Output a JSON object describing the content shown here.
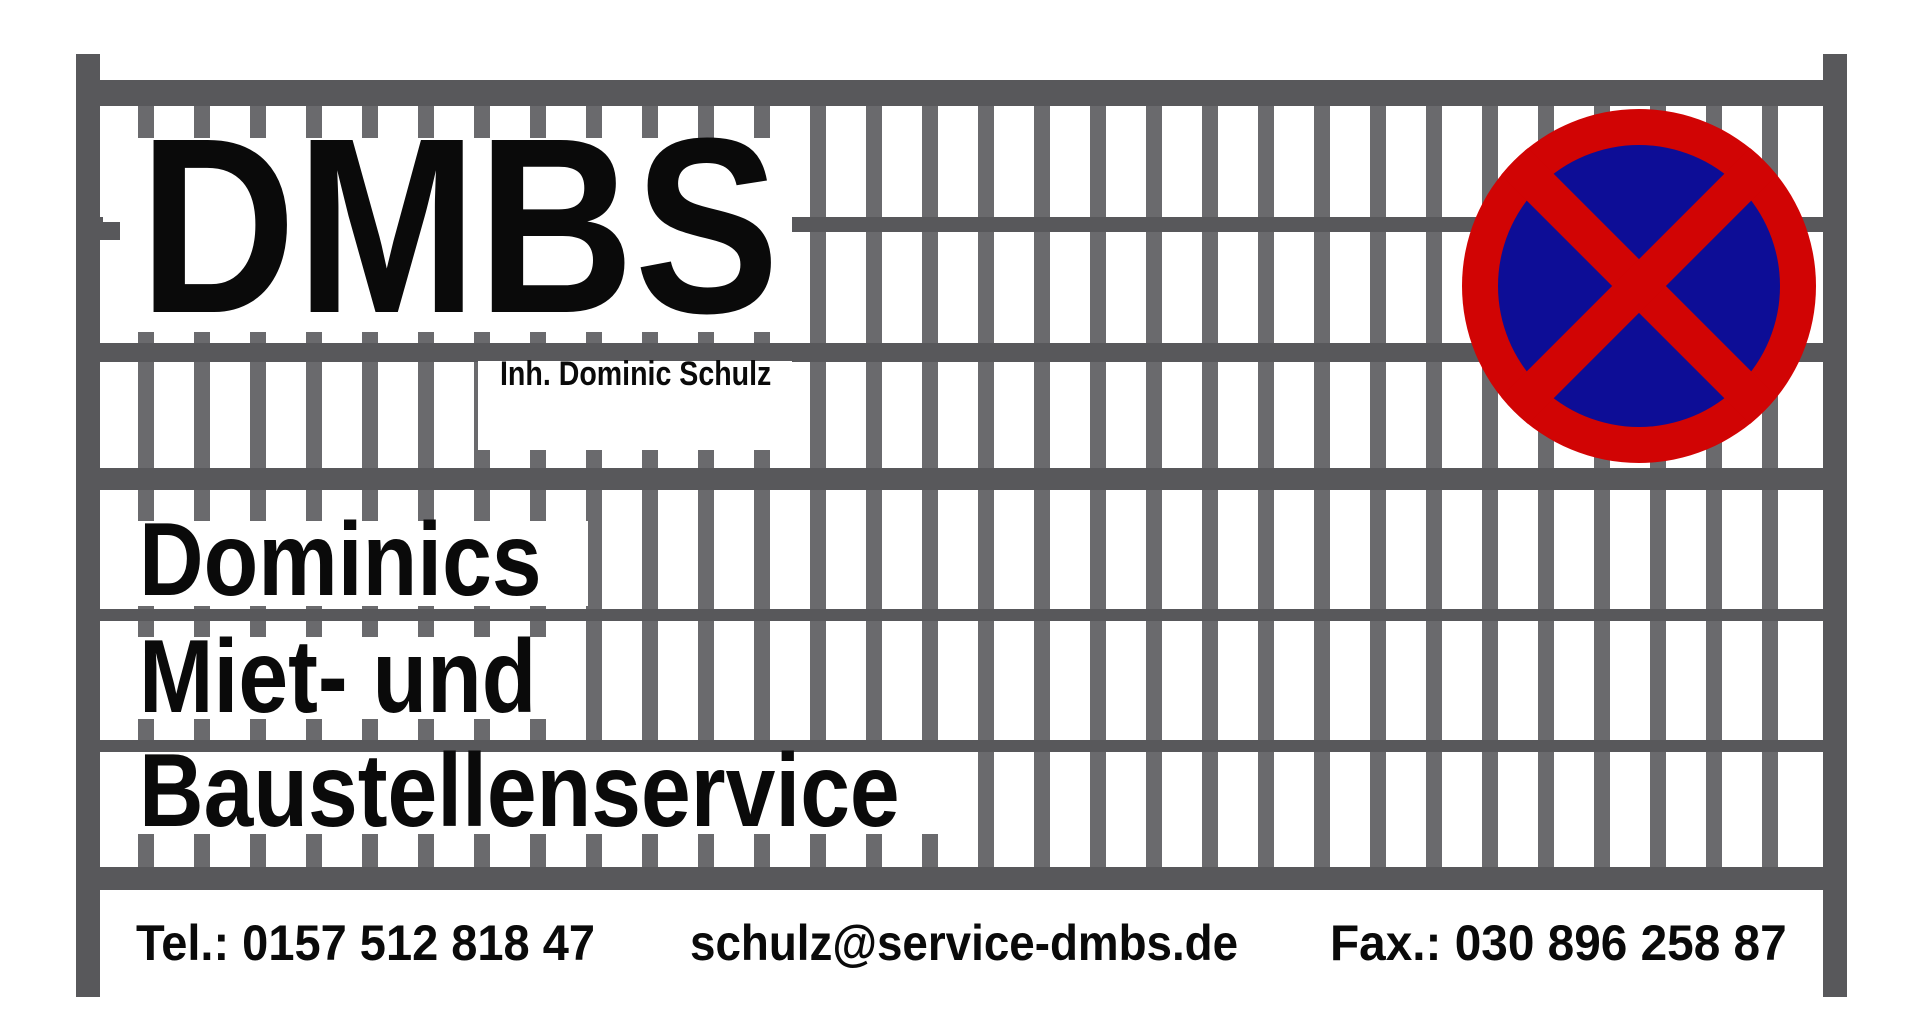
{
  "brand": {
    "name": "DMBS",
    "owner": "Inh. Dominic Schulz"
  },
  "tagline": {
    "line1": "Dominics",
    "line2": "Miet- und",
    "line3": "Baustellenservice"
  },
  "contact": {
    "phone": "Tel.: 0157 512 818 47",
    "email": "schulz@service-dmbs.de",
    "fax": "Fax.: 030 896 258 87"
  },
  "sign": {
    "meaning": "no-stopping-sign",
    "ring_color": "#d10404",
    "center_color": "#0d0d96"
  },
  "fence": {
    "frame_color": "#58585b",
    "bar_color": "#6a6a6d"
  },
  "text_color": "#0a0a0a",
  "background_color": "#ffffff"
}
